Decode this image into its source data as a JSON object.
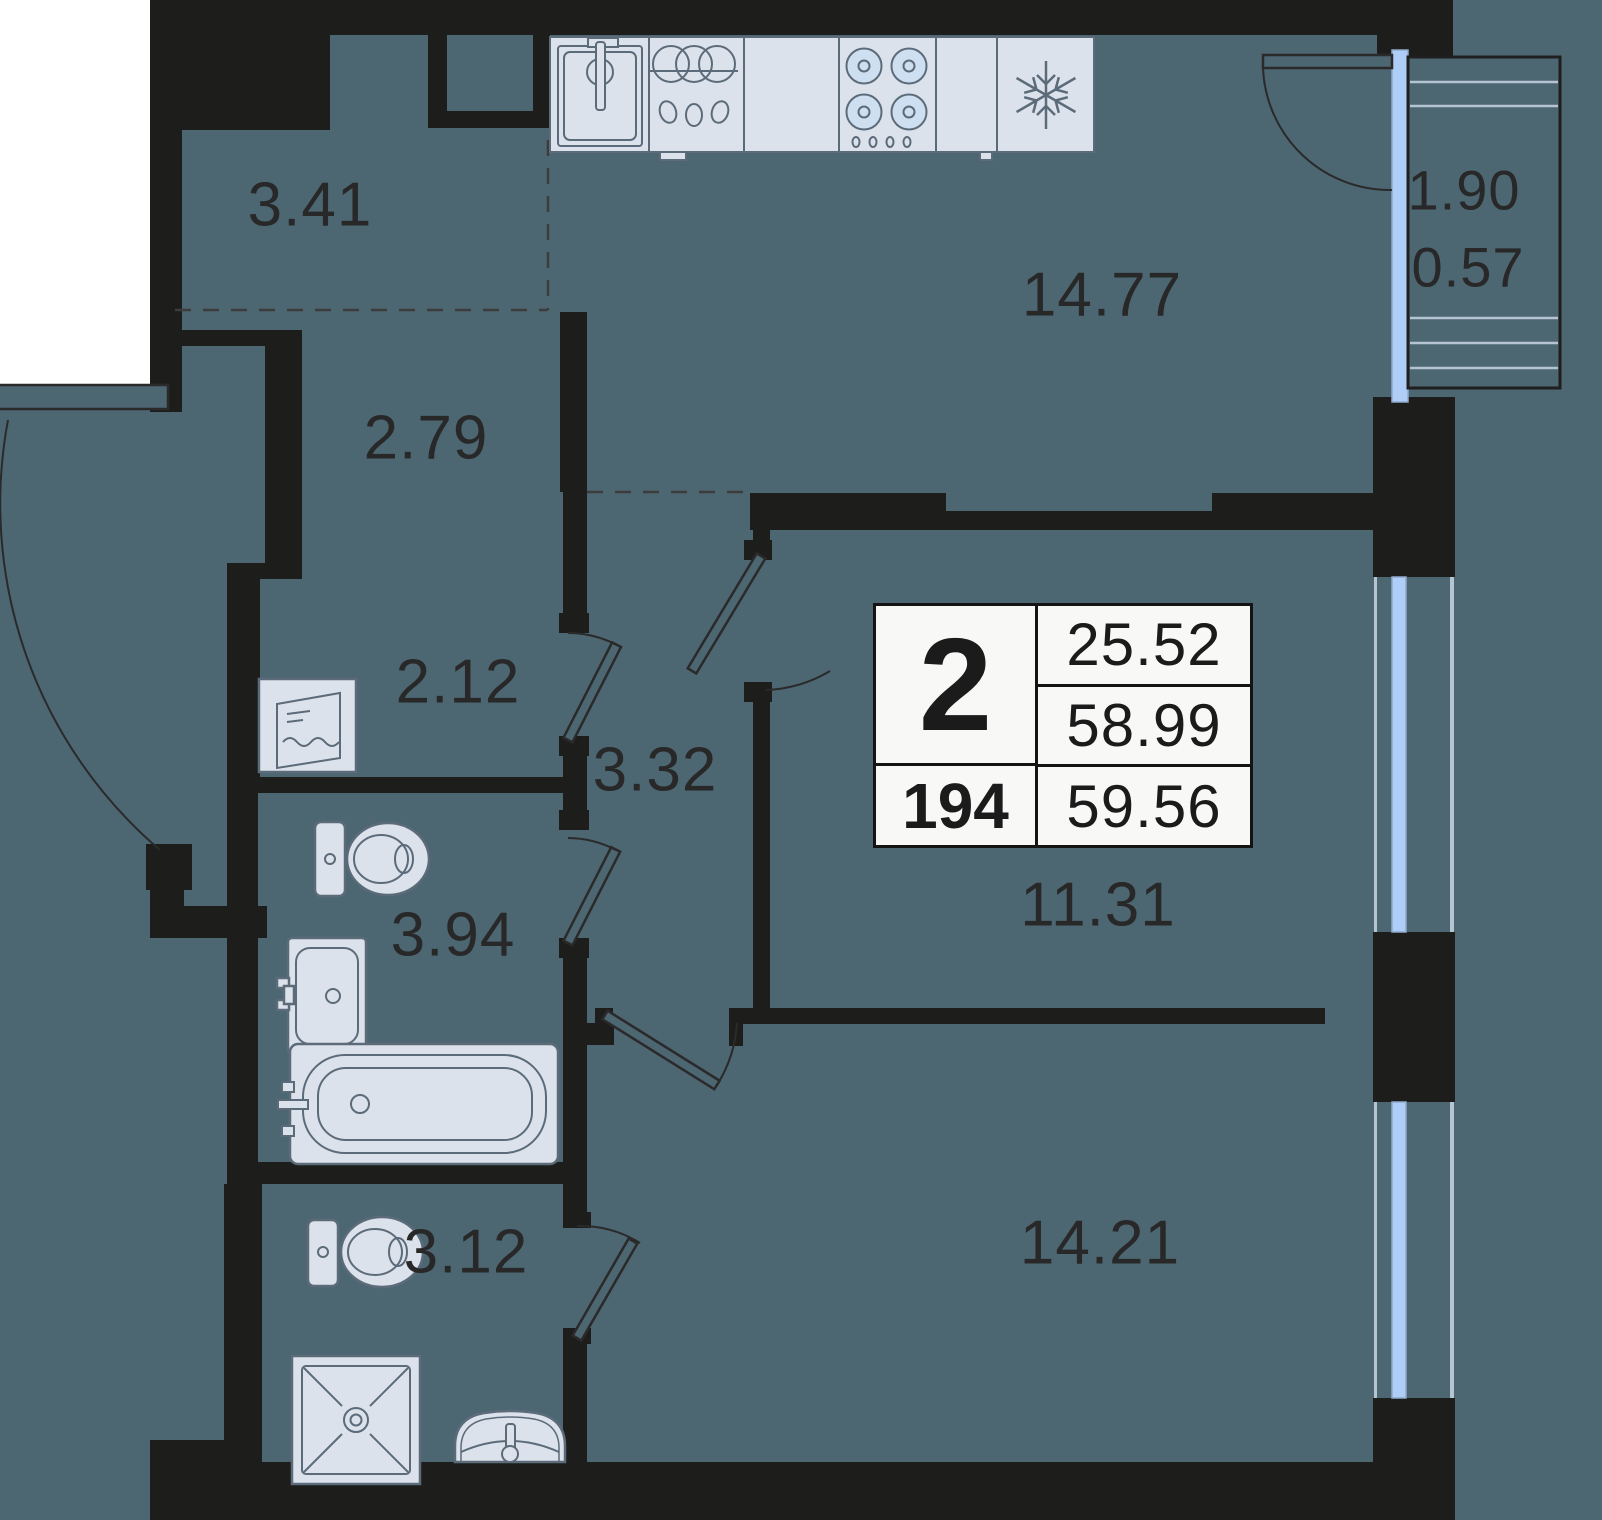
{
  "plan": {
    "background_color": "#4C6672",
    "wall_color": "#1D1E1C",
    "outside_color": "#FFFFFF",
    "fixture_fill": "#D9DFE9",
    "fixture_stroke": "#5C6B7A",
    "glazing_color": "#AECDF7",
    "glazing_line_color": "#B6C3D1",
    "text_color": "#282828",
    "table_background": "#F8F8F6"
  },
  "rooms": [
    {
      "id": "entry-hall",
      "area": "3.41"
    },
    {
      "id": "corridor",
      "area": "2.79"
    },
    {
      "id": "storage",
      "area": "2.12"
    },
    {
      "id": "inner-hall",
      "area": "3.32"
    },
    {
      "id": "bathroom",
      "area": "3.94"
    },
    {
      "id": "shower-room",
      "area": "3.12"
    },
    {
      "id": "kitchen-living",
      "area": "14.77"
    },
    {
      "id": "room-1",
      "area": "11.31"
    },
    {
      "id": "room-2",
      "area": "14.21"
    }
  ],
  "balcony": {
    "length": "1.90",
    "area": "0.57"
  },
  "summary": {
    "rooms_count": "2",
    "living_area": "25.52",
    "area_without_balcony": "58.99",
    "apartment_number": "194",
    "total_area": "59.56"
  },
  "icons": [
    "kitchen-sink-icon",
    "dish-dryer-icon",
    "cooktop-icon",
    "fridge-snowflake-icon",
    "washing-machine-icon",
    "toilet-icon",
    "wash-basin-icon",
    "bathtub-icon",
    "shower-tray-icon",
    "corner-basin-icon"
  ]
}
